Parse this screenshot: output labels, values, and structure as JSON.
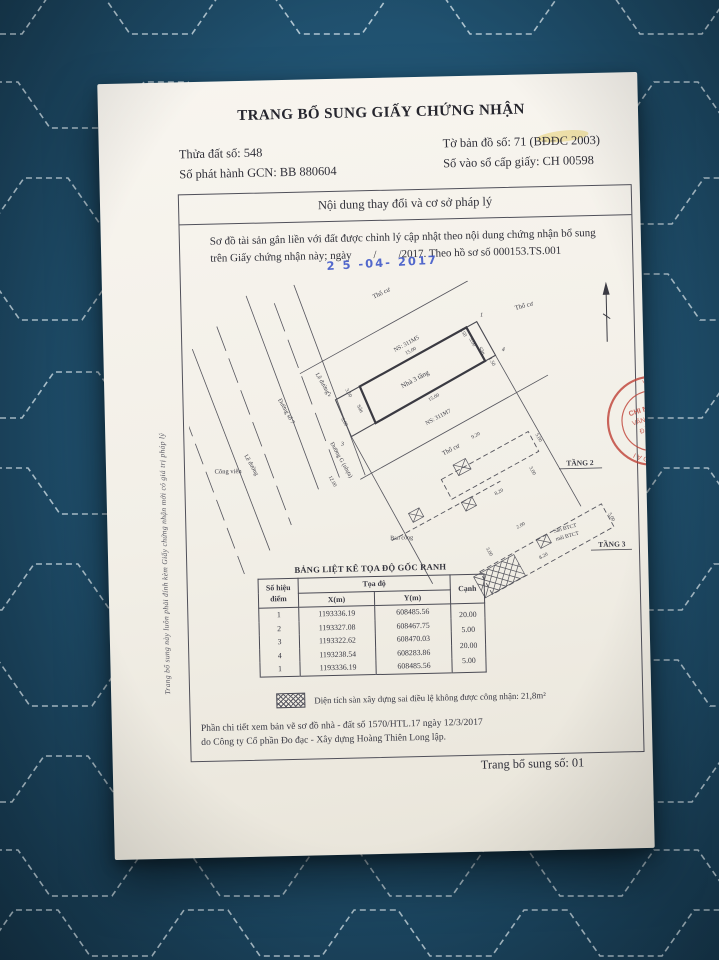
{
  "colors": {
    "fabric": "#215473",
    "stitch": "#d9e8ef",
    "paper": "#f2efe7",
    "ink": "#2f2f38",
    "stamp_blue": "#3c55c8",
    "stamp_red": "#bf4136"
  },
  "header": {
    "title": "TRANG BỔ SUNG GIẤY CHỨNG NHẬN",
    "parcel": "Thửa đất số: 548",
    "issue_no": "Số phát hành GCN: BB 880604",
    "map_sheet": "Tờ bản đồ số: 71 (BĐĐC 2003)",
    "registry_no": "Số vào sổ cấp giấy: CH 00598"
  },
  "content_box": {
    "heading": "Nội dung thay đổi và cơ sở pháp lý",
    "para_line1": "Sơ đồ tài sản gắn liền với đất được chỉnh lý cập nhật theo nội dung chứng nhận bổ sung",
    "para_line2": "trên Giấy chứng nhận này; ngày        /        /2017. Theo hồ sơ số 000153.TS.001",
    "date_stamp": "2 5 -04- 2017"
  },
  "diagram": {
    "labels": {
      "tho_cu_top": "Thổ cư",
      "tho_cu_right": "Thổ cư",
      "tho_cu_bottom": "Thổ cư",
      "ns_top": "NS: 311M5",
      "house": "Nhà 3 tầng",
      "ns_bottom": "NS: 311M7",
      "san_left": "Sân",
      "san_right": "Sân",
      "cong_vien": "Công viên",
      "le_duong_1": "Lề đường",
      "le_duong_2": "Lề đường",
      "duong_so_7": "Đường số 7",
      "duong_g": "Đường G (nhựa)",
      "ban_cong": "Ban công",
      "tang_2": "TẦNG 2",
      "tang_3": "TẦNG 3",
      "san_btct": "Sàn BTCT",
      "mai_btct": "mái BTCT",
      "p1": "1",
      "p2": "2",
      "p3": "3",
      "p4": "4"
    },
    "dims": {
      "top": "15.00",
      "bottom": "15.00",
      "road": "12.00",
      "l1": "3.50",
      "l2": "5.00",
      "r1": "1.50",
      "r2": "5.00",
      "r3": "1.50",
      "t2a": "9.20",
      "t2b": "5.00",
      "t2c": "8.20",
      "t2d": "3.00",
      "t3a": "8.20",
      "t3b": "5.00",
      "t3c": "3.00",
      "t3d": "2.00"
    }
  },
  "table": {
    "title": "BẢNG LIỆT KÊ TỌA ĐỘ GỐC RANH",
    "col_point_1": "Số hiệu",
    "col_point_2": "điểm",
    "col_coords": "Tọa độ",
    "col_x": "X(m)",
    "col_y": "Y(m)",
    "col_edge": "Cạnh",
    "rows": [
      {
        "p": "1",
        "x": "1193336.19",
        "y": "608485.56"
      },
      {
        "p": "2",
        "x": "1193327.08",
        "y": "608467.75"
      },
      {
        "p": "3",
        "x": "1193322.62",
        "y": "608470.03"
      },
      {
        "p": "4",
        "x": "1193238.54",
        "y": "608283.86"
      },
      {
        "p": "1",
        "x": "1193336.19",
        "y": "608485.56"
      }
    ],
    "edges": [
      "20.00",
      "5.00",
      "20.00",
      "5.00"
    ]
  },
  "legend": {
    "text": "Diện tích sàn xây dựng sai điều lệ không được công nhận: 21,8m²"
  },
  "footer": {
    "detail_1": "Phần chi tiết xem bản vẽ sơ đồ nhà - đất số 1570/HTL.17 ngày 12/3/2017",
    "detail_2": "do Công ty Cổ phần Đo đạc - Xây dựng Hoàng Thiên Long lập.",
    "page_no": "Trang bổ sung số: 01"
  },
  "margin_note": "Trang bổ sung này luôn phải đính kèm Giấy chứng nhận mới có giá trị pháp lý",
  "red_stamp": {
    "ring_text": "VĂN PHÒNG ĐĂNG KÝ ĐẤT ĐAI",
    "l1": "CHI NHÁNH",
    "l2": "VĂN PHÒNG",
    "l3": "ĐĂNG KÝ",
    "l4": "QUẬN"
  }
}
